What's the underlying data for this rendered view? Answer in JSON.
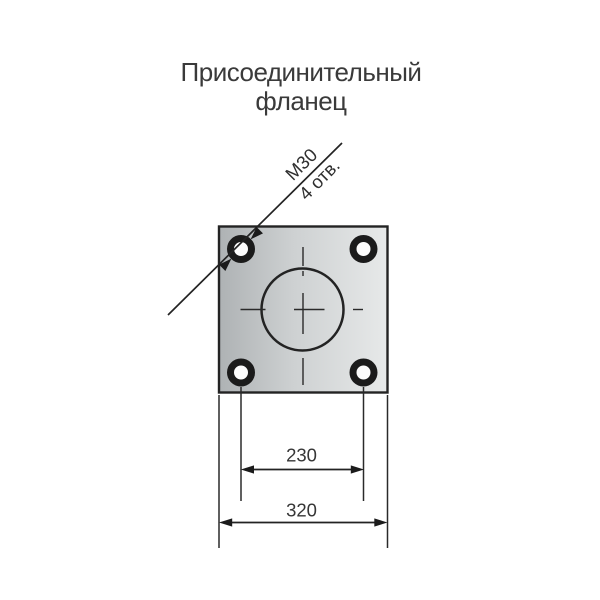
{
  "title": {
    "line1": "Присоединительный",
    "line2": "фланец"
  },
  "callout": {
    "line1": "М30",
    "line2": "4 отв."
  },
  "dimensions": {
    "bolt_hole_spacing": "230",
    "flange_width": "320"
  },
  "drawing": {
    "bolt_hole_count": 4,
    "colors": {
      "background": "#ffffff",
      "line": "#232323",
      "centerline": "#2a2a2a",
      "text": "#3a3a3a",
      "plate_dark": "#aeb2b4",
      "plate_mid": "#ced1d2",
      "plate_light": "#e7e9e9",
      "hole_inner": "#fcfcfc"
    }
  }
}
